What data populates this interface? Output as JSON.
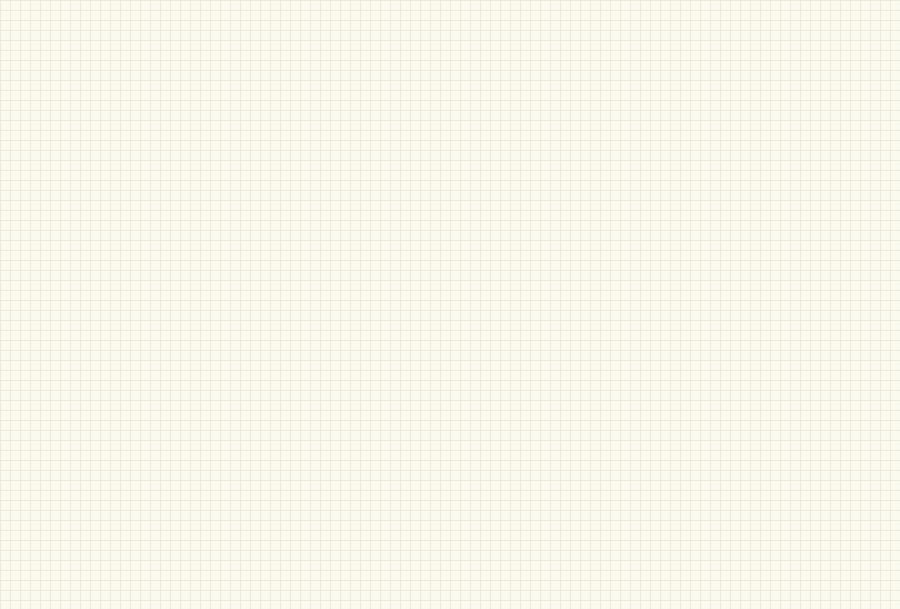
{
  "palette": {
    "wire": "#0000A0",
    "body_fill": "#FFFFB0",
    "body_border": "#8A6200",
    "net_color": "#8B0000",
    "power_color": "#CC0000",
    "dot_color": "#802020"
  },
  "hc595": {
    "part_number": "SN74HC595D",
    "top_pin_names": [
      "GND",
      "SER",
      "SRCLK",
      "SRCLR",
      "RCLK",
      "OE"
    ],
    "out_pin_names": [
      "QH'",
      "QH",
      "QG",
      "QF",
      "QE",
      "QD",
      "QC",
      "QB",
      "QA"
    ],
    "out_pin_names_r2": [
      "QA",
      "QB",
      "QC",
      "QD",
      "QE",
      "QF",
      "QG",
      "QH",
      "QH'"
    ],
    "bottom_pin_names_r2": [
      "OE",
      "RCLK",
      "SRCLR",
      "SRCLK",
      "SER",
      "GND"
    ],
    "vcc_pin_name": "VCC",
    "row1_top_numbers": [
      "14",
      "11",
      "10",
      "12",
      "13"
    ],
    "row1_shared_nets": [
      "SCLK",
      "VCC",
      "LCHR",
      "ENR"
    ],
    "row1_out_numbers": [
      "9",
      "7",
      "6",
      "5",
      "4",
      "3",
      "2",
      "1",
      "15"
    ],
    "vcc_number": "16",
    "gnd_number": "8",
    "row2_top_numbers": [
      "16",
      "15",
      "1",
      "2",
      "3",
      "4",
      "5",
      "6",
      "7",
      "9"
    ],
    "row2_bottom_numbers": [
      "13",
      "12",
      "10",
      "11",
      "14",
      "8"
    ],
    "row2_shared": {
      "srclr": "VCC",
      "srclk": "SCLK"
    },
    "power_net": "VCC"
  },
  "row1_ics": [
    {
      "ref": "U4",
      "ser_net": "DR3",
      "qh2_net": "",
      "out_nets": [
        "R32",
        "R31",
        "R30",
        "R29",
        "R28",
        "R27",
        "R26",
        "R25"
      ]
    },
    {
      "ref": "U5",
      "ser_net": "DR2",
      "qh2_net": "DR3",
      "out_nets": [
        "R24",
        "R23",
        "R22",
        "R21",
        "R20",
        "R19",
        "R18",
        "R17"
      ]
    },
    {
      "ref": "U6",
      "ser_net": "DR1",
      "qh2_net": "DR2",
      "out_nets": [
        "R16",
        "R15",
        "R14",
        "R13",
        "R12",
        "R11",
        "R10",
        "R9"
      ]
    },
    {
      "ref": "U7",
      "ser_net": "DRIN",
      "qh2_net": "DR1",
      "out_nets": [
        "R8",
        "R7",
        "R6",
        "R5",
        "R4",
        "R3",
        "R2",
        "R1"
      ]
    }
  ],
  "row2_ics": [
    {
      "ref": "U8",
      "ser_net": "DG3",
      "qh2_net": "",
      "oe_net": "ENG",
      "rclk_net": "LCHG",
      "oe_grounded": false,
      "out_nets": [
        "G25",
        "G26",
        "G27",
        "G28",
        "G29",
        "G30",
        "G31",
        "G32"
      ]
    },
    {
      "ref": "U12",
      "ser_net": "DG2",
      "qh2_net": "DG3",
      "oe_net": "ENG",
      "rclk_net": "LCHG",
      "oe_grounded": false,
      "out_nets": [
        "G17",
        "G18",
        "G19",
        "G20",
        "G21",
        "G22",
        "G23",
        "G24"
      ]
    },
    {
      "ref": "U10",
      "ser_net": "DG1",
      "qh2_net": "DG2",
      "oe_net": "ENG",
      "rclk_net": "LCHG",
      "oe_grounded": false,
      "out_nets": [
        "G9",
        "G10",
        "G11",
        "G12",
        "G13",
        "G14",
        "G15",
        "G16"
      ]
    },
    {
      "ref": "U11",
      "ser_net": "DGIN",
      "qh2_net": "DG1",
      "oe_net": "ENG",
      "rclk_net": "LCHG",
      "oe_grounded": false,
      "out_nets": [
        "G1",
        "G2",
        "G3",
        "G4",
        "G5",
        "G6",
        "G7",
        "G8"
      ]
    },
    {
      "ref": "U9",
      "ser_net": "DC",
      "qh2_net": "",
      "oe_net": "",
      "rclk_net": "LCHC",
      "oe_grounded": true,
      "out_nets": [
        "CON1",
        "CON2",
        "CON3",
        "CON4",
        "CON5",
        "CON6",
        "CON7",
        "CON8"
      ]
    }
  ],
  "mcu": {
    "ref": "U1",
    "part": "ATmega8-16AI",
    "power_net": "VCC",
    "left_pins": [
      {
        "num": "12",
        "name": "PB0 (ICP)",
        "net": "LCHR"
      },
      {
        "num": "13",
        "name": "PB1 (OC1A)",
        "net": "ENR"
      },
      {
        "num": "14",
        "name": "PB2 (SS/OC1B)",
        "net": "ENG"
      },
      {
        "num": "15",
        "name": "PB3 (MOSI/OC2)",
        "net": "LCHG"
      },
      {
        "num": "16",
        "name": "PB4 (MISO)",
        "net": "DGIN"
      },
      {
        "num": "17",
        "name": "PB5 (SCK)",
        "net": "SCK"
      },
      {
        "num": "7",
        "name": "PB6 (XTAL1/TOSC1)"
      },
      {
        "num": "8",
        "name": "PB7 (XTAL2/TOSC2)"
      },
      {
        "num": "30",
        "name": "PD0 (RXD)"
      },
      {
        "num": "31",
        "name": "PD1 (TXD)"
      },
      {
        "num": "32",
        "name": "PD2 (INT0)"
      },
      {
        "num": "1",
        "name": "PD3 (INT1)"
      },
      {
        "num": "2",
        "name": "PD4 (XCK/T0)"
      },
      {
        "num": "9",
        "name": "PD5 (T1)",
        "net": "DRIN"
      },
      {
        "num": "10",
        "name": "PD6 (AIN0)",
        "net": "SCLK"
      },
      {
        "num": "11",
        "name": "PD7 (AIN1)",
        "net": "LCHC"
      }
    ],
    "right_pins": [
      {
        "num": "23",
        "name": "PC0 (ADC0)"
      },
      {
        "num": "24",
        "name": "PC1 (ADC1)"
      },
      {
        "num": "25",
        "name": "PC2 (ADC2)",
        "net": "BELL"
      },
      {
        "num": "26",
        "name": "PC3 (ADC3)",
        "net": "SCLKD"
      },
      {
        "num": "27",
        "name": "PC4 (ADC4/SDA)",
        "net": "DAT"
      },
      {
        "num": "28",
        "name": "PC5 (ADC5/SCL)",
        "net": "RST"
      },
      {
        "num": "19",
        "name": "ADC6"
      },
      {
        "num": "22",
        "name": "ADC7",
        "net": "AIN"
      },
      {
        "num": "29",
        "name": "PC6 (RESET)"
      },
      {
        "num": "6",
        "name": "VCC"
      },
      {
        "num": "4",
        "name": "VCC"
      },
      {
        "num": "18",
        "name": "AVCC"
      },
      {
        "num": "20",
        "name": "AREF"
      },
      {
        "num": "21",
        "name": "GND"
      },
      {
        "num": "5",
        "name": "GND"
      },
      {
        "num": "3",
        "name": "GND"
      }
    ],
    "xtal": {
      "ref": "Y1",
      "label": "XTAL",
      "p1": "1",
      "p2": "2"
    }
  },
  "amp": {
    "ref": "U13",
    "part": "LM386M-1",
    "vs": "VS",
    "byp": "BYP",
    "gain": "GAIN",
    "gnd": "GND",
    "minus": "-",
    "plus": "+",
    "audio_net": "AUDIO",
    "ain_net": "AIN",
    "power_net": "VCC",
    "nums": {
      "in_minus": "2",
      "in_plus": "3",
      "gnd": "4",
      "vs": "6",
      "out": "5",
      "byp": "7",
      "gain1": "1",
      "gain8": "8"
    },
    "cap": {
      "ref": "C1",
      "type": "Cap Pol1",
      "value": "2.2UF",
      "plus": "+"
    }
  },
  "rtc": {
    "ref": "U2",
    "part": "DS1302SN",
    "power_net": "VCC",
    "left": [
      {
        "num": "7",
        "name": "SCLK",
        "net": "SCLKD"
      },
      {
        "num": "5",
        "name": "RST",
        "net": "RST"
      },
      {
        "num": "2",
        "name": "X1"
      },
      {
        "num": "3",
        "name": "X2"
      },
      {
        "num": "4",
        "name": "GND"
      }
    ],
    "right": [
      {
        "num": "8",
        "name": "VCC1"
      },
      {
        "num": "1",
        "name": "VCC2"
      },
      {
        "num": "6",
        "name": "I/O",
        "net": "DAT"
      }
    ],
    "xtal": {
      "ref": "Y2",
      "label": "XTAL",
      "p1": "1",
      "p2": "2"
    }
  },
  "header": {
    "ref": "JP1",
    "part": "Header 3",
    "pin_labels": [
      "3",
      "2",
      "1"
    ],
    "c2": "C2",
    "c3": "C3",
    "plus": "+",
    "audio_net": "AUDIO"
  },
  "bell": {
    "label": "Bell",
    "ref": "LS",
    "net": "BELL"
  },
  "battery": {
    "ref": "BT",
    "part": "Battery"
  },
  "driver": {
    "power_net": "VCC",
    "transistor_type": "NPN",
    "resistor_type": "Res2",
    "resistor_value": "1K",
    "cells": [
      {
        "q": "Q1",
        "r": "R1",
        "in": "CON1",
        "out": "VC1"
      },
      {
        "q": "Q2",
        "r": "R2",
        "in": "CON2",
        "out": "VC2"
      },
      {
        "q": "Q3",
        "r": "R3",
        "in": "CON3",
        "out": "VC3"
      },
      {
        "q": "Q4",
        "r": "R4",
        "in": "CON4",
        "out": "VC4"
      },
      {
        "q": "Q5",
        "r": "R5",
        "in": "CON5",
        "out": "VC5"
      },
      {
        "q": "Q6",
        "r": "R6",
        "in": "CON6",
        "out": "VC6"
      },
      {
        "q": "Q7",
        "r": "R7",
        "in": "CON7",
        "out": "VC7"
      },
      {
        "q": "Q8",
        "r": "R8",
        "in": "CON8",
        "out": "VC8"
      }
    ]
  }
}
